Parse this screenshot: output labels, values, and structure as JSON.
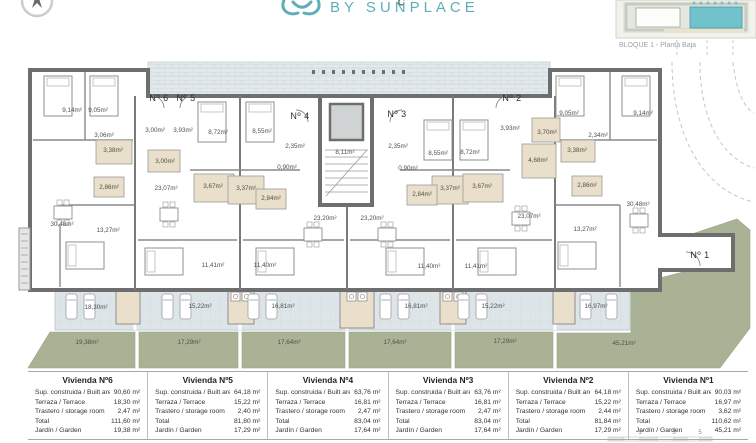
{
  "header": {
    "logo_text": "BY SUNPLACE",
    "brand_color": "#5fafba",
    "keymap_caption": "BLOQUE 1 - Planta Baja"
  },
  "plan": {
    "wall_color": "#6e6e6e",
    "terrace_color": "#dde5e8",
    "garden_color": "#a9b295",
    "bath_color": "#eadfca",
    "walkway_color": "#e2e9ec",
    "unit_labels": [
      {
        "text": "Nº 6",
        "x": 159,
        "y": 101
      },
      {
        "text": "Nº 5",
        "x": 186,
        "y": 101
      },
      {
        "text": "Nº 4",
        "x": 300,
        "y": 119
      },
      {
        "text": "Nº 3",
        "x": 397,
        "y": 117
      },
      {
        "text": "Nº 2",
        "x": 512,
        "y": 101
      },
      {
        "text": "Nº 1",
        "x": 700,
        "y": 258
      }
    ],
    "room_labels": [
      {
        "text": "9,14m²",
        "x": 72,
        "y": 112
      },
      {
        "text": "9,05m²",
        "x": 98,
        "y": 112
      },
      {
        "text": "3,06m²",
        "x": 104,
        "y": 137
      },
      {
        "text": "3,00m²",
        "x": 155,
        "y": 132
      },
      {
        "text": "3,93m²",
        "x": 183,
        "y": 132
      },
      {
        "text": "3,38m²",
        "x": 113,
        "y": 152
      },
      {
        "text": "3,00m²",
        "x": 165,
        "y": 163
      },
      {
        "text": "2,86m²",
        "x": 109,
        "y": 189
      },
      {
        "text": "23,07m²",
        "x": 166,
        "y": 190
      },
      {
        "text": "30,48m²",
        "x": 62,
        "y": 226
      },
      {
        "text": "13,27m²",
        "x": 108,
        "y": 232
      },
      {
        "text": "8,72m²",
        "x": 218,
        "y": 134
      },
      {
        "text": "8,55m²",
        "x": 262,
        "y": 133
      },
      {
        "text": "2,35m²",
        "x": 295,
        "y": 148
      },
      {
        "text": "0,90m²",
        "x": 287,
        "y": 169
      },
      {
        "text": "3,67m²",
        "x": 213,
        "y": 188
      },
      {
        "text": "3,37m²",
        "x": 246,
        "y": 190
      },
      {
        "text": "2,84m²",
        "x": 271,
        "y": 200
      },
      {
        "text": "8,11m²",
        "x": 345,
        "y": 154
      },
      {
        "text": "23,20m²",
        "x": 325,
        "y": 220
      },
      {
        "text": "23,20m²",
        "x": 372,
        "y": 220
      },
      {
        "text": "11,41m²",
        "x": 213,
        "y": 267
      },
      {
        "text": "11,40m²",
        "x": 265,
        "y": 267
      },
      {
        "text": "2,35m²",
        "x": 398,
        "y": 148
      },
      {
        "text": "0,90m²",
        "x": 408,
        "y": 170
      },
      {
        "text": "8,55m²",
        "x": 438,
        "y": 155
      },
      {
        "text": "8,72m²",
        "x": 470,
        "y": 154
      },
      {
        "text": "3,37m²",
        "x": 450,
        "y": 190
      },
      {
        "text": "3,67m²",
        "x": 482,
        "y": 188
      },
      {
        "text": "2,84m²",
        "x": 422,
        "y": 196
      },
      {
        "text": "11,40m²",
        "x": 429,
        "y": 268
      },
      {
        "text": "11,41m²",
        "x": 476,
        "y": 268
      },
      {
        "text": "3,93m²",
        "x": 510,
        "y": 130
      },
      {
        "text": "23,07m²",
        "x": 529,
        "y": 218
      },
      {
        "text": "3,70m²",
        "x": 547,
        "y": 134
      },
      {
        "text": "4,68m²",
        "x": 538,
        "y": 162
      },
      {
        "text": "3,38m²",
        "x": 577,
        "y": 152
      },
      {
        "text": "2,34m²",
        "x": 598,
        "y": 137
      },
      {
        "text": "2,86m²",
        "x": 587,
        "y": 187
      },
      {
        "text": "9,05m²",
        "x": 569,
        "y": 115
      },
      {
        "text": "9,14m²",
        "x": 643,
        "y": 115
      },
      {
        "text": "30,48m²",
        "x": 638,
        "y": 206
      },
      {
        "text": "13,27m²",
        "x": 585,
        "y": 231
      },
      {
        "text": "18,30m²",
        "x": 96,
        "y": 309
      },
      {
        "text": "15,22m²",
        "x": 200,
        "y": 308
      },
      {
        "text": "16,81m²",
        "x": 283,
        "y": 308
      },
      {
        "text": "16,81m²",
        "x": 416,
        "y": 308
      },
      {
        "text": "15,22m²",
        "x": 493,
        "y": 308
      },
      {
        "text": "16,97m²",
        "x": 596,
        "y": 308
      },
      {
        "text": "19,38m²",
        "x": 87,
        "y": 344
      },
      {
        "text": "17,29m²",
        "x": 189,
        "y": 344
      },
      {
        "text": "17,64m²",
        "x": 289,
        "y": 344
      },
      {
        "text": "17,64m²",
        "x": 395,
        "y": 344
      },
      {
        "text": "17,29m²",
        "x": 505,
        "y": 343
      },
      {
        "text": "45,21m²",
        "x": 624,
        "y": 345
      }
    ]
  },
  "scalebar": {
    "ticks": [
      "1",
      "3",
      "5"
    ]
  },
  "table": {
    "row_labels": [
      "Sup. construida / Built area",
      "Terraza / Terrace",
      "Trastero / storage room",
      "Total",
      "Jardín / Garden"
    ],
    "units": [
      {
        "name": "Vivienda Nº6",
        "values": [
          "90,60 m²",
          "18,30 m²",
          "2,47 m²",
          "111,60 m²",
          "19,38 m²"
        ]
      },
      {
        "name": "Vivienda Nº5",
        "values": [
          "64,18 m²",
          "15,22 m²",
          "2,40 m²",
          "81,80 m²",
          "17,29 m²"
        ]
      },
      {
        "name": "Vivienda Nº4",
        "values": [
          "63,76 m²",
          "16,81 m²",
          "2,47 m²",
          "83,04 m²",
          "17,64 m²"
        ]
      },
      {
        "name": "Vivienda Nº3",
        "values": [
          "63,76 m²",
          "16,81 m²",
          "2,47 m²",
          "83,04 m²",
          "17,64 m²"
        ]
      },
      {
        "name": "Vivienda Nº2",
        "values": [
          "64,18 m²",
          "15,22 m²",
          "2,44 m²",
          "81,84 m²",
          "17,29 m²"
        ]
      },
      {
        "name": "Vivienda Nº1",
        "values": [
          "90,03 m²",
          "16,97 m²",
          "3,62 m²",
          "110,62 m²",
          "45,21 m²"
        ]
      }
    ]
  }
}
